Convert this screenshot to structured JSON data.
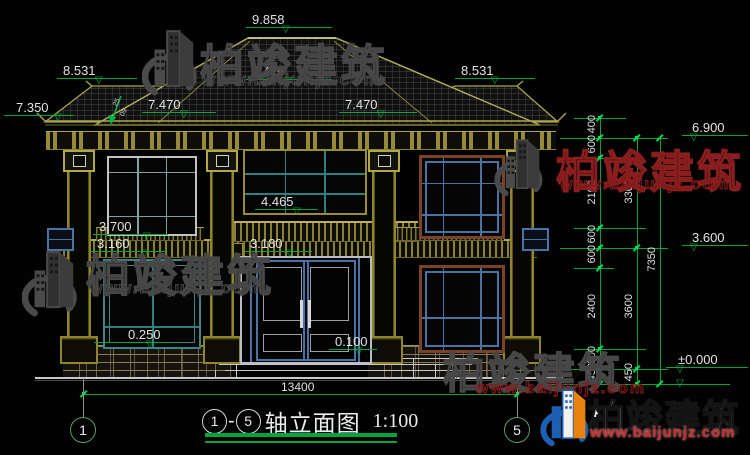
{
  "title_bar": {
    "axis_start": "1",
    "axis_end": "5",
    "dash": "-",
    "name": "轴立面图",
    "scale": "1:100"
  },
  "axis_bubbles": {
    "left": "1",
    "right": "5"
  },
  "markers": {
    "peak": "9.858",
    "mid_roof": "8.476",
    "wing_left": "8.531",
    "wing_right": "8.531",
    "roof_left": "7.470",
    "roof_right": "7.470",
    "eave_left": "7.350",
    "sill_2f": "3.700",
    "band_left": "3.160",
    "glass_sill": "4.465",
    "door_head": "3.180",
    "base_left": "0.250",
    "door_base": "0.100",
    "right_eave": "6.900",
    "right_mid": "3.600",
    "right_zero": "±0.000"
  },
  "dims": {
    "overall_width": "13400",
    "right_total": "7350",
    "right_chain_inner": [
      "400",
      "600",
      "2100",
      "600",
      "600",
      "2400",
      "600",
      "450"
    ],
    "right_chain_outer": [
      "3300",
      "3600",
      "450"
    ]
  },
  "slope_marker": {
    "upper": "25",
    "lower": "09"
  },
  "watermark": {
    "brand": "柏竣建筑",
    "url": "www.baijunjz.com"
  },
  "logo": {
    "brand": "柏竣建筑",
    "url": "www.baijunjz.com"
  },
  "colors": {
    "dim_green": "#00a63c",
    "arch_yellow": "#9a8f2e",
    "watermark_red": "#8a1d1d",
    "logo_blue": "#1d5fb0",
    "logo_orange": "#e8820c"
  }
}
